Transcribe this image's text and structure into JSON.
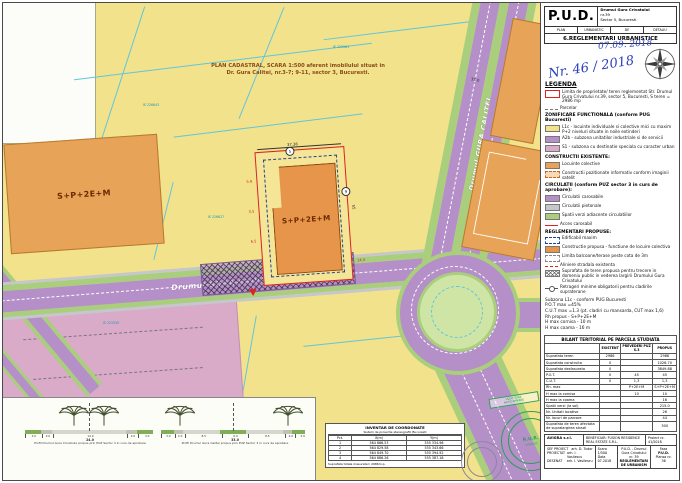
{
  "header": {
    "pud": "P.U.D.",
    "addr1": "Drumul Gura Crivatului",
    "addr2": "nr.39",
    "addr3": "Sector 5, Bucuresti",
    "row": [
      "PLAN",
      "URBANISTIC",
      "DE",
      "DETALIU"
    ],
    "sheet_title": "6.REGLEMENTARI URBANISTICE",
    "date_hw": "07.09. 2018",
    "no_hw": "Nr. 46 / 2018"
  },
  "legend": {
    "title": "LEGENDA",
    "entries": [
      {
        "label": "Limita de proprietate/ teren reglementat Str. Drumul Gura Crivatului nr.39, sector 5, Bucuresti, S teren = 2986 mp"
      },
      {
        "label": "Parcelar"
      },
      {
        "label": "ZONIFICARE FUNCTIONALA (conform PUG Bucuresti)"
      },
      {
        "label": "L1c - locuinte individuale si colective mici cu maxim P+2 niveluri situate in noile extinderi"
      },
      {
        "label": "A2b - subzona unitatilor industriale si de servicii"
      },
      {
        "label": "S1 - subzona cu destinatie speciala cu caracter urban"
      },
      {
        "label": "CONSTRUCTII EXISTENTE:"
      },
      {
        "label": "Locuinte colective"
      },
      {
        "label": "Constructii pozitionate informativ conform imaginii satelit"
      },
      {
        "label": "CIRCULATII (conform PUZ sector 3 in curs de aprobare):"
      },
      {
        "label": "Circulatii carosabile"
      },
      {
        "label": "Circulatii pietonale"
      },
      {
        "label": "Spatii verzi adiacente circulatiilor"
      },
      {
        "label": "Acces carosabil"
      },
      {
        "label": "REGLEMENTARI PROPUSE:"
      },
      {
        "label": "Edificabil maxim"
      },
      {
        "label": "Constructie propusa - functiune de locuire colectiva"
      },
      {
        "label": "Limita balcoane/terase peste cota de 3m"
      },
      {
        "label": "Aliniere stradala existenta"
      },
      {
        "label": "Suprafata de teren propusa pentru trecere in domeniu public in vederea largirii Drumului Gura Crivatului"
      },
      {
        "label": "Retrageri minime obligatorii pentru cladirile supraterane"
      }
    ],
    "indicators": [
      "Subzona L1c - conform PUG Bucuresti",
      "P.O.T max =45%",
      "C.U.T max =1.3 (pt. cladiri cu mansarda, CUT max 1,6)",
      "Rh propus - S+P+2E+M",
      "H max cornisa - 10 m",
      "H max coama - 16 m"
    ]
  },
  "bilant": {
    "title": "BILANT TERITORIAL PE PARCELA STUDIATA",
    "columns": [
      "",
      "EXISTENT",
      "PREVEDERI PUZ S.3",
      "PROPUS"
    ],
    "rows": [
      [
        "Suprafata teren",
        "2986",
        "",
        "2986"
      ],
      [
        "Suprafata construita",
        "0",
        "",
        "1026.70"
      ],
      [
        "Suprafata desfasurata",
        "0",
        "",
        "3849.88"
      ],
      [
        "P.O.T.",
        "0",
        "45",
        "45"
      ],
      [
        "C.U.T.",
        "0",
        "1,3",
        "1,3"
      ],
      [
        "Rh. max",
        "",
        "P+2E+M",
        "S+P+2E+M"
      ],
      [
        "H max la cornisa",
        "",
        "10",
        "10"
      ],
      [
        "H max la coama",
        "",
        "",
        "16"
      ],
      [
        "Spatii verzi (la sol)",
        "",
        "",
        "215.0"
      ],
      [
        "Nr. Unitati locative",
        "",
        "",
        "26"
      ],
      [
        "Nr. locuri de parcare",
        "",
        "",
        "44"
      ],
      [
        "Suprafata de teren afectata de supralargirea strazii",
        "",
        "",
        "300"
      ]
    ]
  },
  "footer": {
    "firm": "AVIGRA s.r.l.",
    "beneficiar_label": "BENEFICIAR:",
    "beneficiar": "FUSION RESIDENCE REAL ESTATE S.R.L.",
    "proiect_label": "Proiect nr.",
    "proiect_nr": "41/2018",
    "roles": [
      [
        "SEF PROIECT",
        "arh. D. Tudor"
      ],
      [
        "PROIECTAT",
        "arh. I. Vasilescu"
      ],
      [
        "DESENAT",
        "arh. I. Vasilescu"
      ]
    ],
    "scara_label": "Scara",
    "scara": "1/500",
    "data_label": "Data",
    "data": "07.2018",
    "title1": "P.U.D. - Drumul Gura Crivatului nr. 39",
    "title2": "REGLEMENTARI DE URBANISM",
    "faza_label": "Faza",
    "faza": "P.U.D.",
    "plansa_label": "Plansa nr.",
    "plansa": "36"
  },
  "map": {
    "plan_title_line1": "PLAN CADASTRAL, SCARA 1:500 aferent imobilului situat in",
    "plan_title_line2": "Dr. Gura Calitei, nr.3-7; 9-11, sector 3, Bucuresti.",
    "road_main": "Drumul GURA CRIVATULUI",
    "road_secondary": "Drumul GURA CALITEI",
    "parcel_left_label": "S+P+2E+M",
    "building_label": "S+P+2E+M",
    "dims": {
      "top": "37.36",
      "left1": "5.9",
      "left2": "3.5",
      "left3": "6.5",
      "right": "14.5",
      "side": "55",
      "road": "33.0"
    },
    "setbacks": [
      "5",
      "9"
    ],
    "ie": [
      "IE 226643",
      "IE 220981",
      "IE 226627",
      "IE 221555"
    ]
  },
  "profiles": [
    {
      "caption": "Profil Drumul Gura Crivatului propus prin PUZ Sector 3 in curs de aprobare",
      "dims": [
        "3.0",
        "2.0",
        "14.0",
        "2.0",
        "3.0"
      ],
      "total": "24.0"
    },
    {
      "caption": "Profil Drumul Gura Calitei propus prin PUZ Sector 3 in curs de aprobare",
      "dims": [
        "3.0",
        "2.0",
        "8.5",
        "6.0",
        "8.5",
        "2.0",
        "3.0"
      ],
      "total": "33.0"
    }
  ],
  "coords": {
    "title": "INVENTAR DE COORDONATE",
    "subtitle": "Sistem de proiectie stereografic Bucuresti",
    "columns": [
      "Pct.",
      "X(m)",
      "Y(m)"
    ],
    "rows": [
      [
        "1",
        "564 866.53",
        "555 334.96"
      ],
      [
        "2",
        "564 829.58",
        "555 343.66"
      ],
      [
        "3",
        "564 849.70",
        "555 394.92"
      ],
      [
        "4",
        "564 886.26",
        "555 387.16"
      ]
    ],
    "total": "Suprafata totala masurata= 2986m.p."
  },
  "stamps": {
    "vizat_line1": "VIZAT SPRE",
    "vizat_line2": "NESCHIMBARE",
    "rur": "R.U.R.",
    "rur_sub": "urbanist"
  },
  "colors": {
    "zone_l1c": "#f2e28c",
    "zone_a2b": "#b58fc8",
    "zone_s1": "#d9abc9",
    "existing_building": "#e7a458",
    "proposed_building": "#e6954a",
    "road_carosabil": "#b58fc8",
    "pietonal": "#c6c6cd",
    "green_space": "#a9cf7d",
    "property_line": "#dd2222",
    "cadastral_line": "#62c5da",
    "handwriting_ink": "#2a3fbf",
    "stamp_green": "#2f9e57"
  }
}
